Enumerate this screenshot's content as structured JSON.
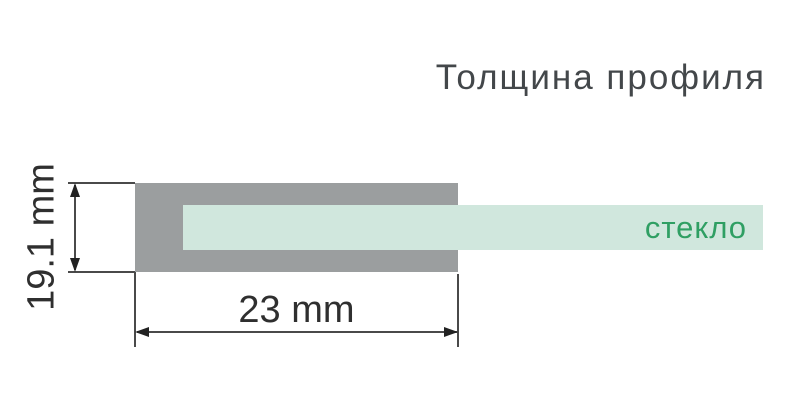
{
  "title": "Толщина профиля",
  "diagram": {
    "glass_label": "стекло",
    "height_dimension": "19.1 mm",
    "width_dimension": "23 mm"
  },
  "colors": {
    "profile_gray": "#9b9e9f",
    "glass_mint": "#d0e7dd",
    "glass_text_green": "#2f9f63",
    "dimension_line": "#4a4a4a",
    "arrow_black": "#222222",
    "dimension_text": "#2f2f2f",
    "title_text": "#43474a",
    "background": "#ffffff"
  }
}
